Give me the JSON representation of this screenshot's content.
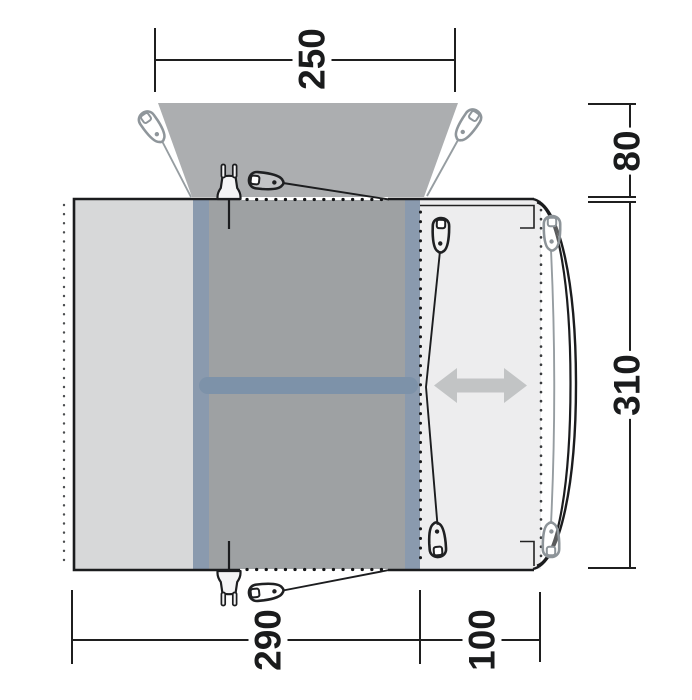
{
  "diagram": {
    "type": "tent-awning-floor-plan",
    "dims": {
      "canopy_width": "250",
      "canopy_depth": "80",
      "body_depth": "310",
      "front_section_width": "290",
      "side_section_width": "100"
    },
    "colors": {
      "canopy_gray": "#acaeb0",
      "inner_room_gray": "#9ea1a3",
      "left_room_gray": "#d7d8d9",
      "side_cabin_gray": "#ededee",
      "accent_blue": "#7d92a9",
      "accent_blue_stripe": "#8a9aae",
      "arrow_gray": "#c2c4c5",
      "line_black": "#1b1c1e",
      "line_gray": "#969da1"
    },
    "icons": [
      "power-plug-icon",
      "guy-rope-peg-icon",
      "left-right-arrow-icon"
    ]
  }
}
